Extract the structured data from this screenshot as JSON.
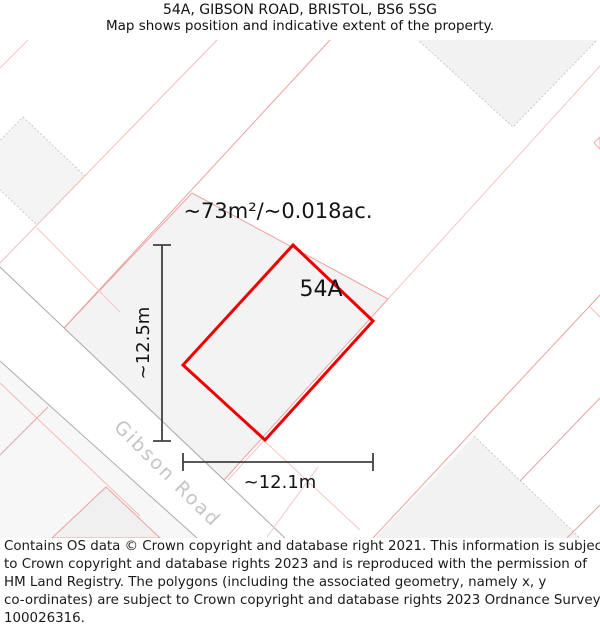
{
  "header": {
    "title": "54A, GIBSON ROAD, BRISTOL, BS6 5SG",
    "subtitle": "Map shows position and indicative extent of the property."
  },
  "map": {
    "area_label": "~73m²/~0.018ac.",
    "property_label": "54A",
    "height_label": "~12.5m",
    "width_label": "~12.1m",
    "road_label": "Gibson Road",
    "colors": {
      "property_outline": "#ee0000",
      "parcel_line_pink": "#eda0a0",
      "parcel_line_pink_light": "#f6c6c6",
      "parcel_fill": "#f3f3f3",
      "road_edge_gray": "#ababab",
      "dimension_color": "#404040",
      "label_color": "#141414",
      "road_label_color": "#c5c5c5"
    }
  },
  "footer": {
    "lines": [
      "Contains OS data © Crown copyright and database right 2021. This information is subject",
      "to Crown copyright and database rights 2023 and is reproduced with the permission of",
      "HM Land Registry. The polygons (including the associated geometry, namely x, y",
      "co-ordinates) are subject to Crown copyright and database rights 2023 Ordnance Survey",
      "100026316."
    ]
  }
}
